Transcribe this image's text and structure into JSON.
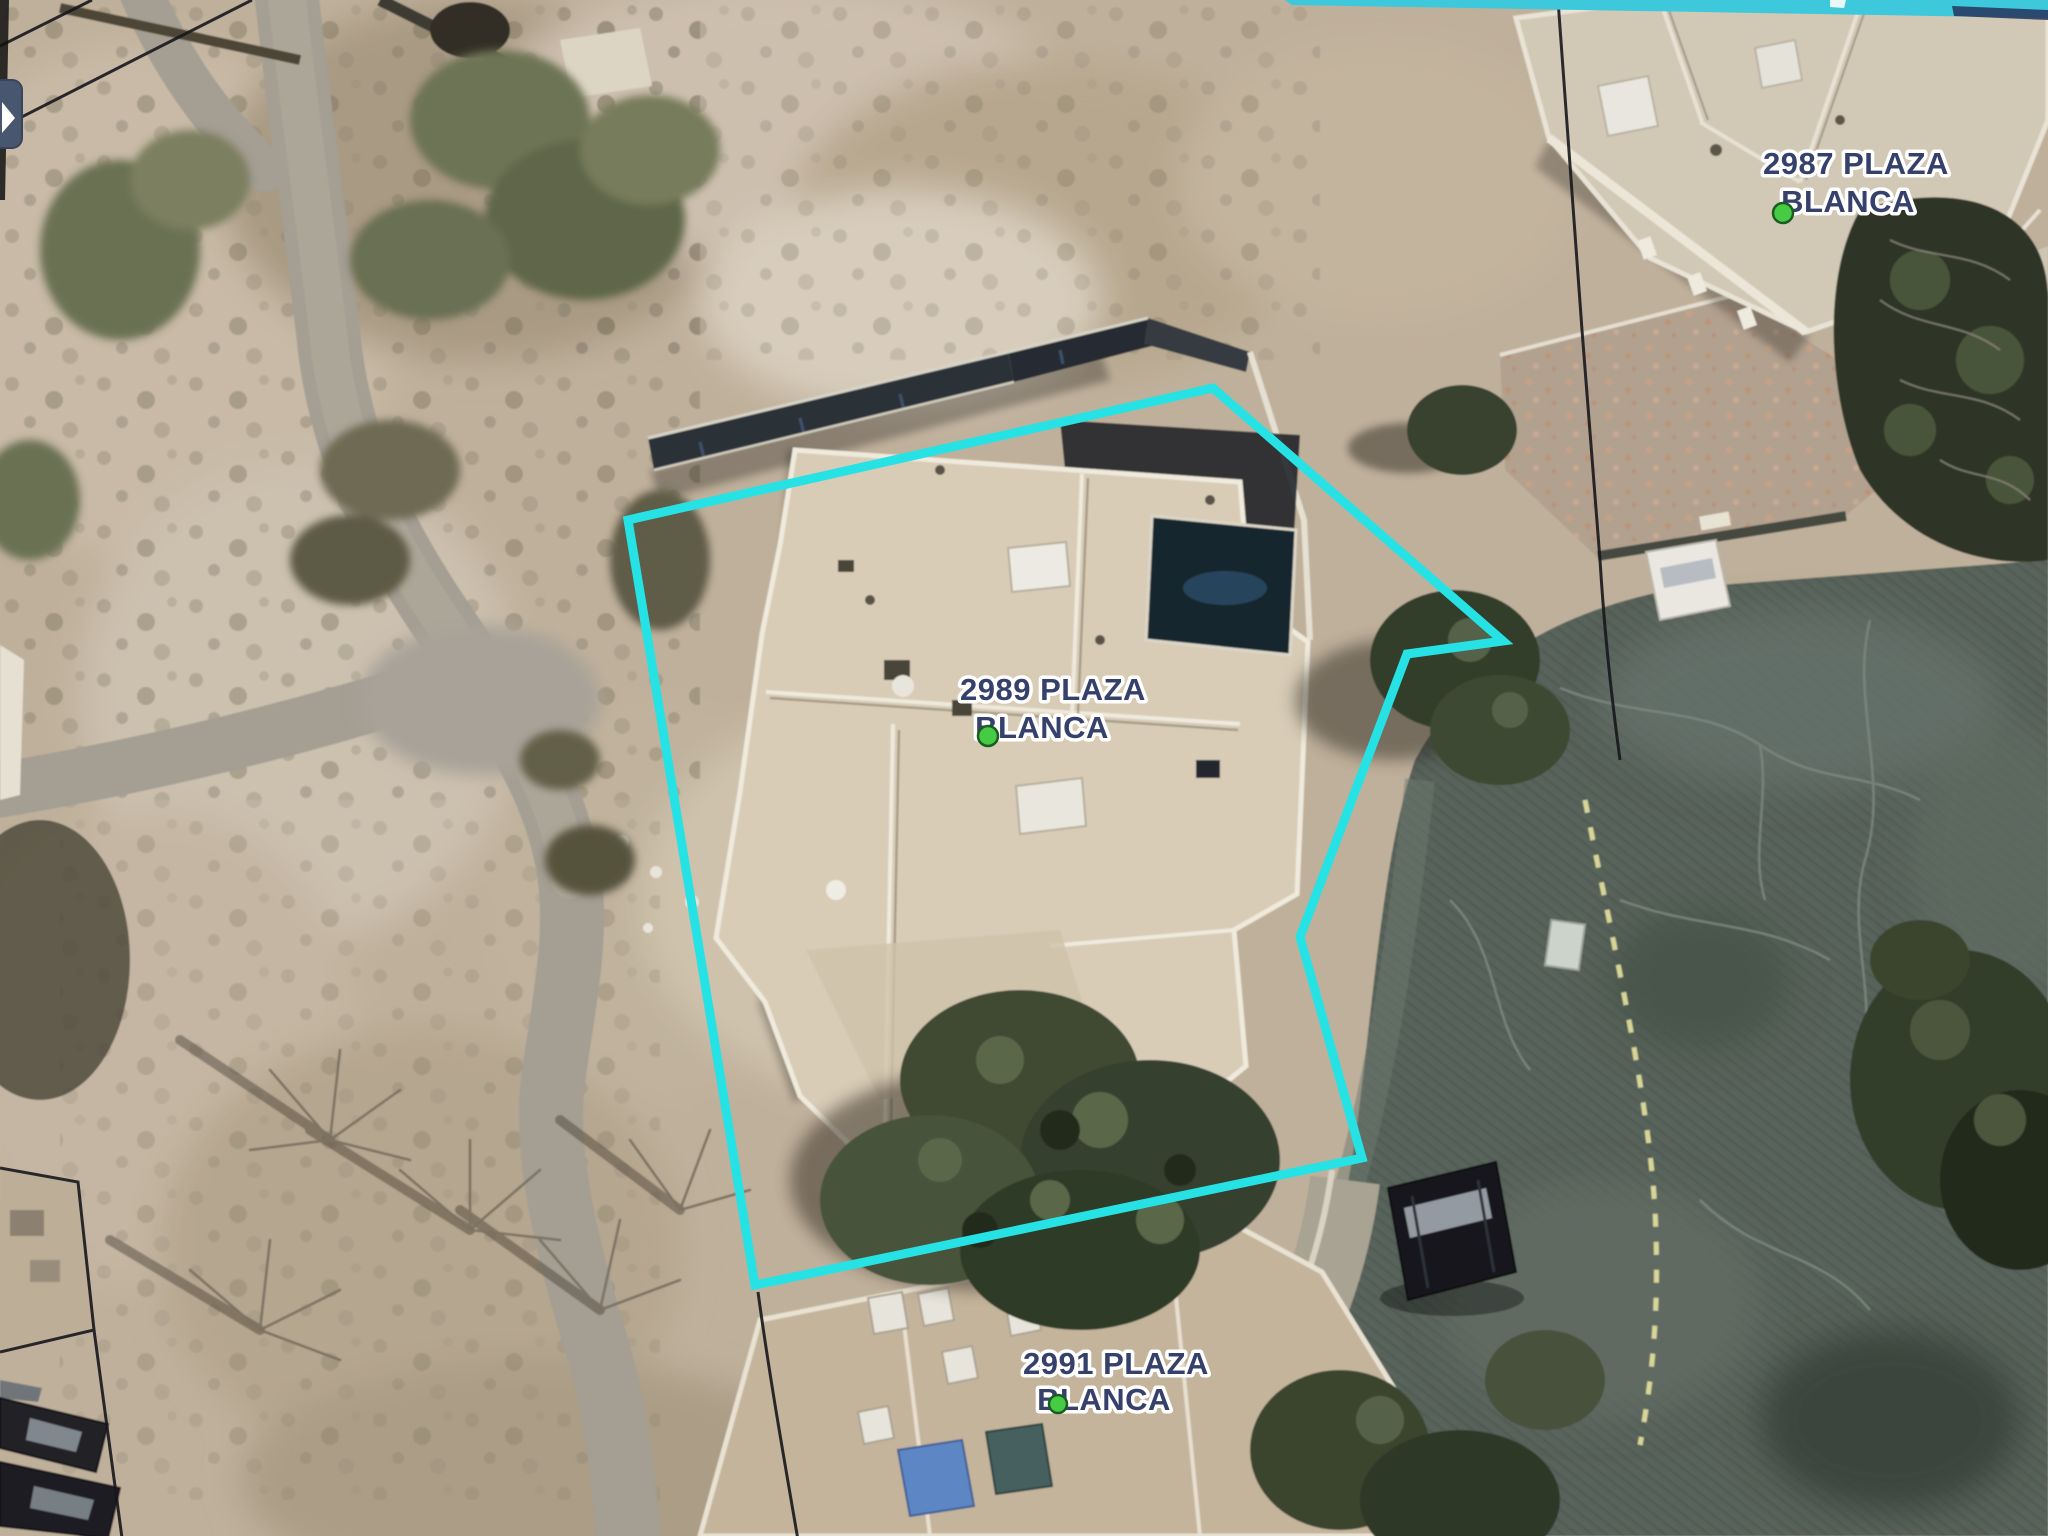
{
  "map": {
    "parcels": [
      {
        "id": "2987",
        "label_line1": "2987 PLAZA",
        "label_line2": "BLANCA"
      },
      {
        "id": "2989",
        "label_line1": "2989 PLAZA",
        "label_line2": "BLANCA"
      },
      {
        "id": "2991",
        "label_line1": "2991 PLAZA",
        "label_line2": "BLANCA"
      }
    ],
    "label_style": {
      "fill": "#35406b",
      "halo": "#ffffff"
    },
    "marker": {
      "fill": "#46cb45",
      "stroke": "#1d5c20"
    },
    "selected_boundary": {
      "stroke": "#27e2e4",
      "stroke_width": "9",
      "points": "628,520 1213,388 1503,641 1407,654 1300,937 1362,1158 755,1285"
    },
    "road": {
      "centerline_color": "#e6e2a0",
      "centerline_dash": "13 15",
      "marking_color": "#ccd3cb"
    }
  },
  "ui": {
    "side_button": {
      "bg": "#49566f",
      "glyph": "cursor-arrow",
      "glyph_color": "#ffffff"
    },
    "screen_top_bar_color": "#3ec8dc"
  }
}
